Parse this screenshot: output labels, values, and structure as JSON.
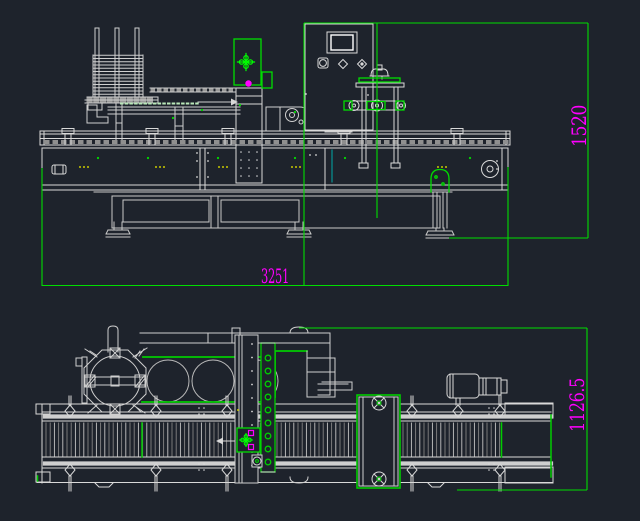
{
  "canvas": {
    "kind": "cad-model-space",
    "background": "#1e232c",
    "width": 640,
    "height": 521
  },
  "palette": {
    "line": "#d9d9d9",
    "bright_line": "#ffffff",
    "dim_green": "#00dd00",
    "bright_green": "#00ff00",
    "magenta": "#ff00ff",
    "cyan": "#00a8a8",
    "yellow": "#c8c800"
  },
  "icons": {
    "crosshair_marker": "cross-petal registration target",
    "spoke_wheel": "circle with spoked hub",
    "hmi_screen": "rectangular operator display",
    "fan_vent": "small square vent with rotor",
    "diamond_knob": "diamond selector knob",
    "flow_arrow": "material flow direction arrow"
  },
  "views": {
    "front": {
      "name": "front-elevation",
      "dimensions": {
        "width": {
          "value": "3251"
        },
        "height": {
          "value": "1520"
        }
      }
    },
    "plan": {
      "name": "top-plan",
      "dimensions": {
        "depth": {
          "value": "1126.5"
        }
      }
    }
  }
}
